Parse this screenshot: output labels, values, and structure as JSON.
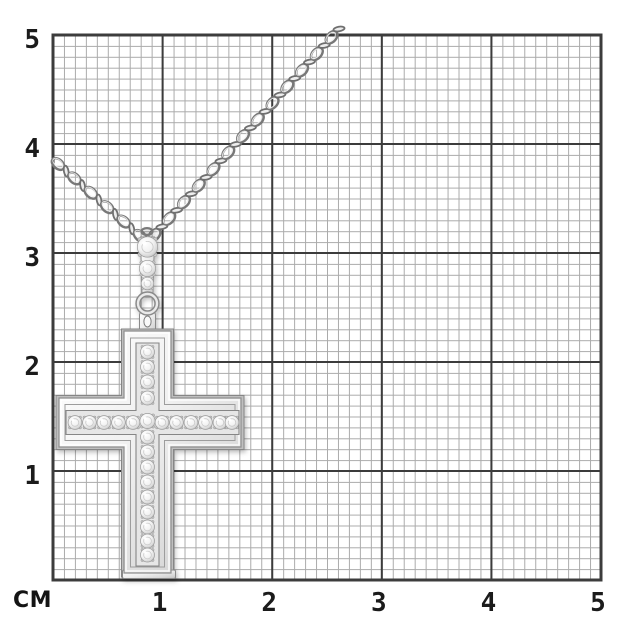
{
  "figure": {
    "alt": "White gold cross pendant with pave-set diamonds hanging on a cable chain, photographed over centimeter grid paper"
  },
  "ruler": {
    "unit_label": "СМ",
    "x_ticks": [
      "1",
      "2",
      "3",
      "4",
      "5"
    ],
    "y_ticks": [
      "5",
      "4",
      "3",
      "2",
      "1"
    ]
  },
  "pendant": {
    "stone_counts": {
      "bail": 3,
      "vertical_row": 14,
      "horizontal_row": 12
    }
  },
  "colors": {
    "background": "#ffffff",
    "minor_grid": "#ababab",
    "major_grid": "#3c3c3c",
    "tick_label": "#1b1b1b",
    "metal_light": "#f7f7f7",
    "metal_mid": "#d9d9d9",
    "metal_dark": "#9a9a9a"
  }
}
